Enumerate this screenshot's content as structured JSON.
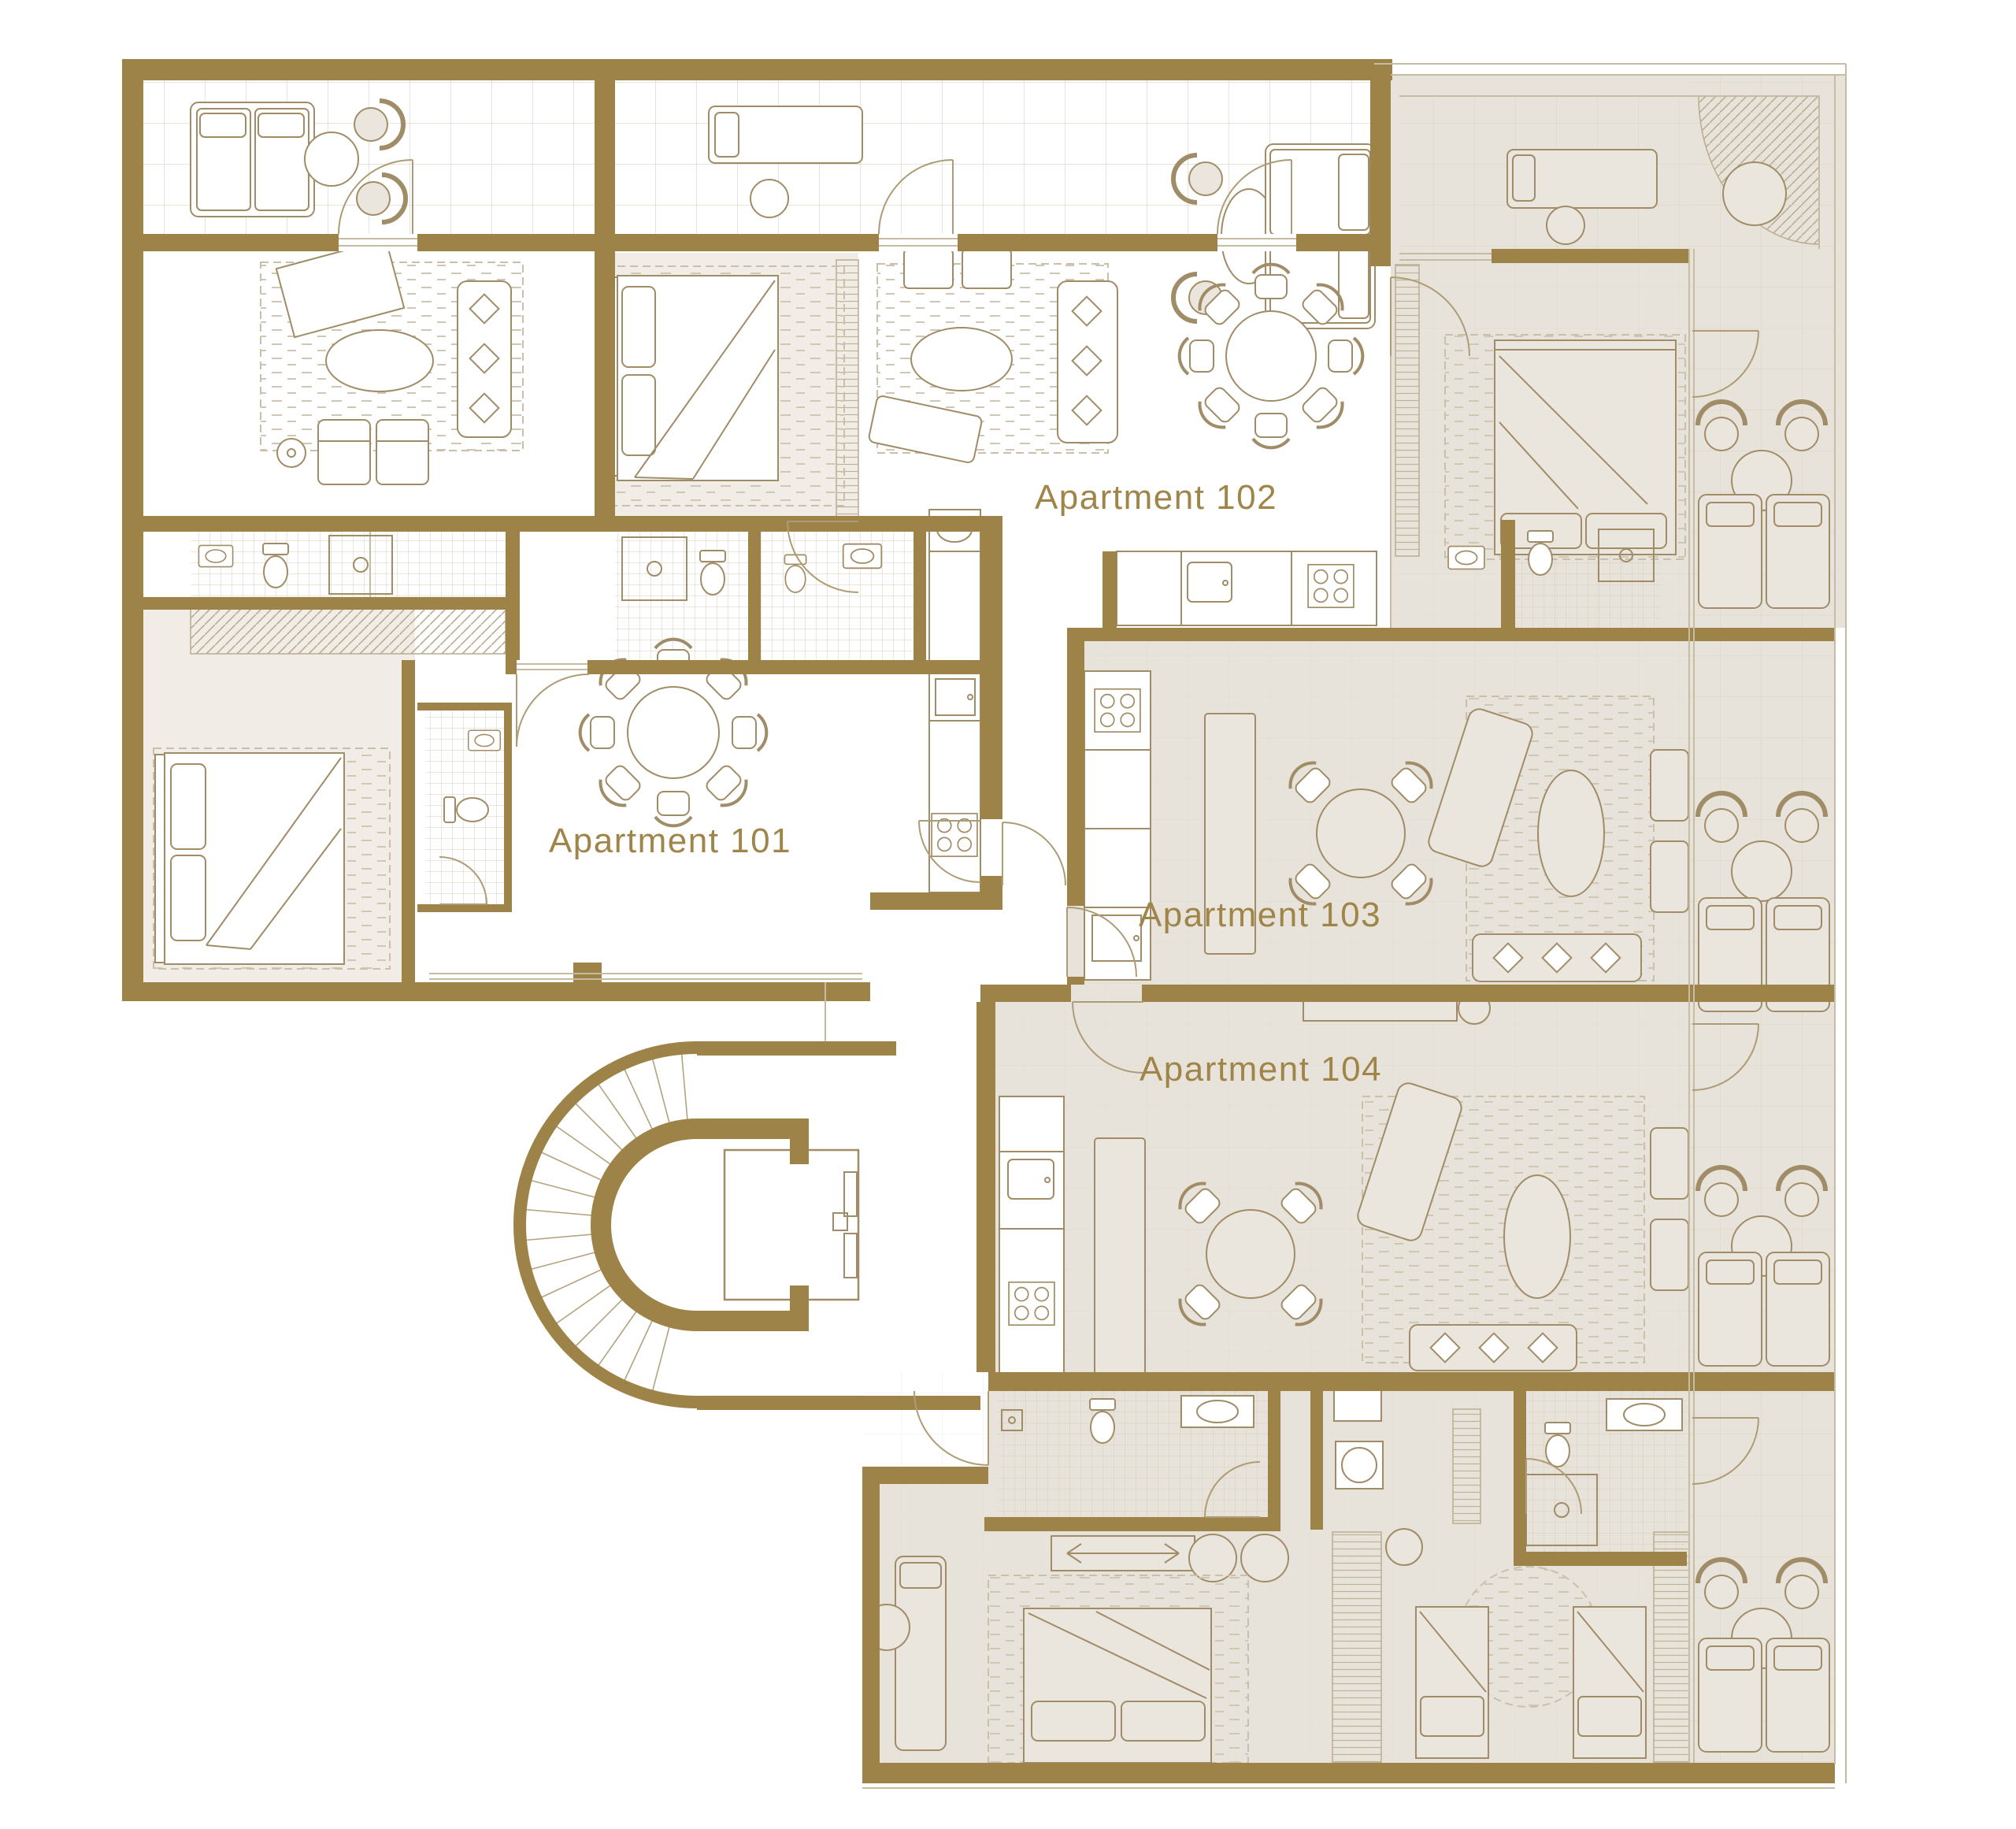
{
  "plan": {
    "apartments": [
      {
        "id": "101",
        "label": "Apartment 101"
      },
      {
        "id": "102",
        "label": "Apartment 102"
      },
      {
        "id": "103",
        "label": "Apartment 103"
      },
      {
        "id": "104",
        "label": "Apartment 104"
      }
    ],
    "colors": {
      "wall": "#9E8349",
      "room_shaded": "#E8E3DA",
      "room_light": "#F1EDE6",
      "furniture_line": "#A08C66",
      "label_text": "#A08549",
      "background": "#FFFFFF"
    },
    "features": {
      "staircase": "spiral-staircase",
      "elevator": "elevator",
      "terraces": "balcony-terraces"
    }
  }
}
